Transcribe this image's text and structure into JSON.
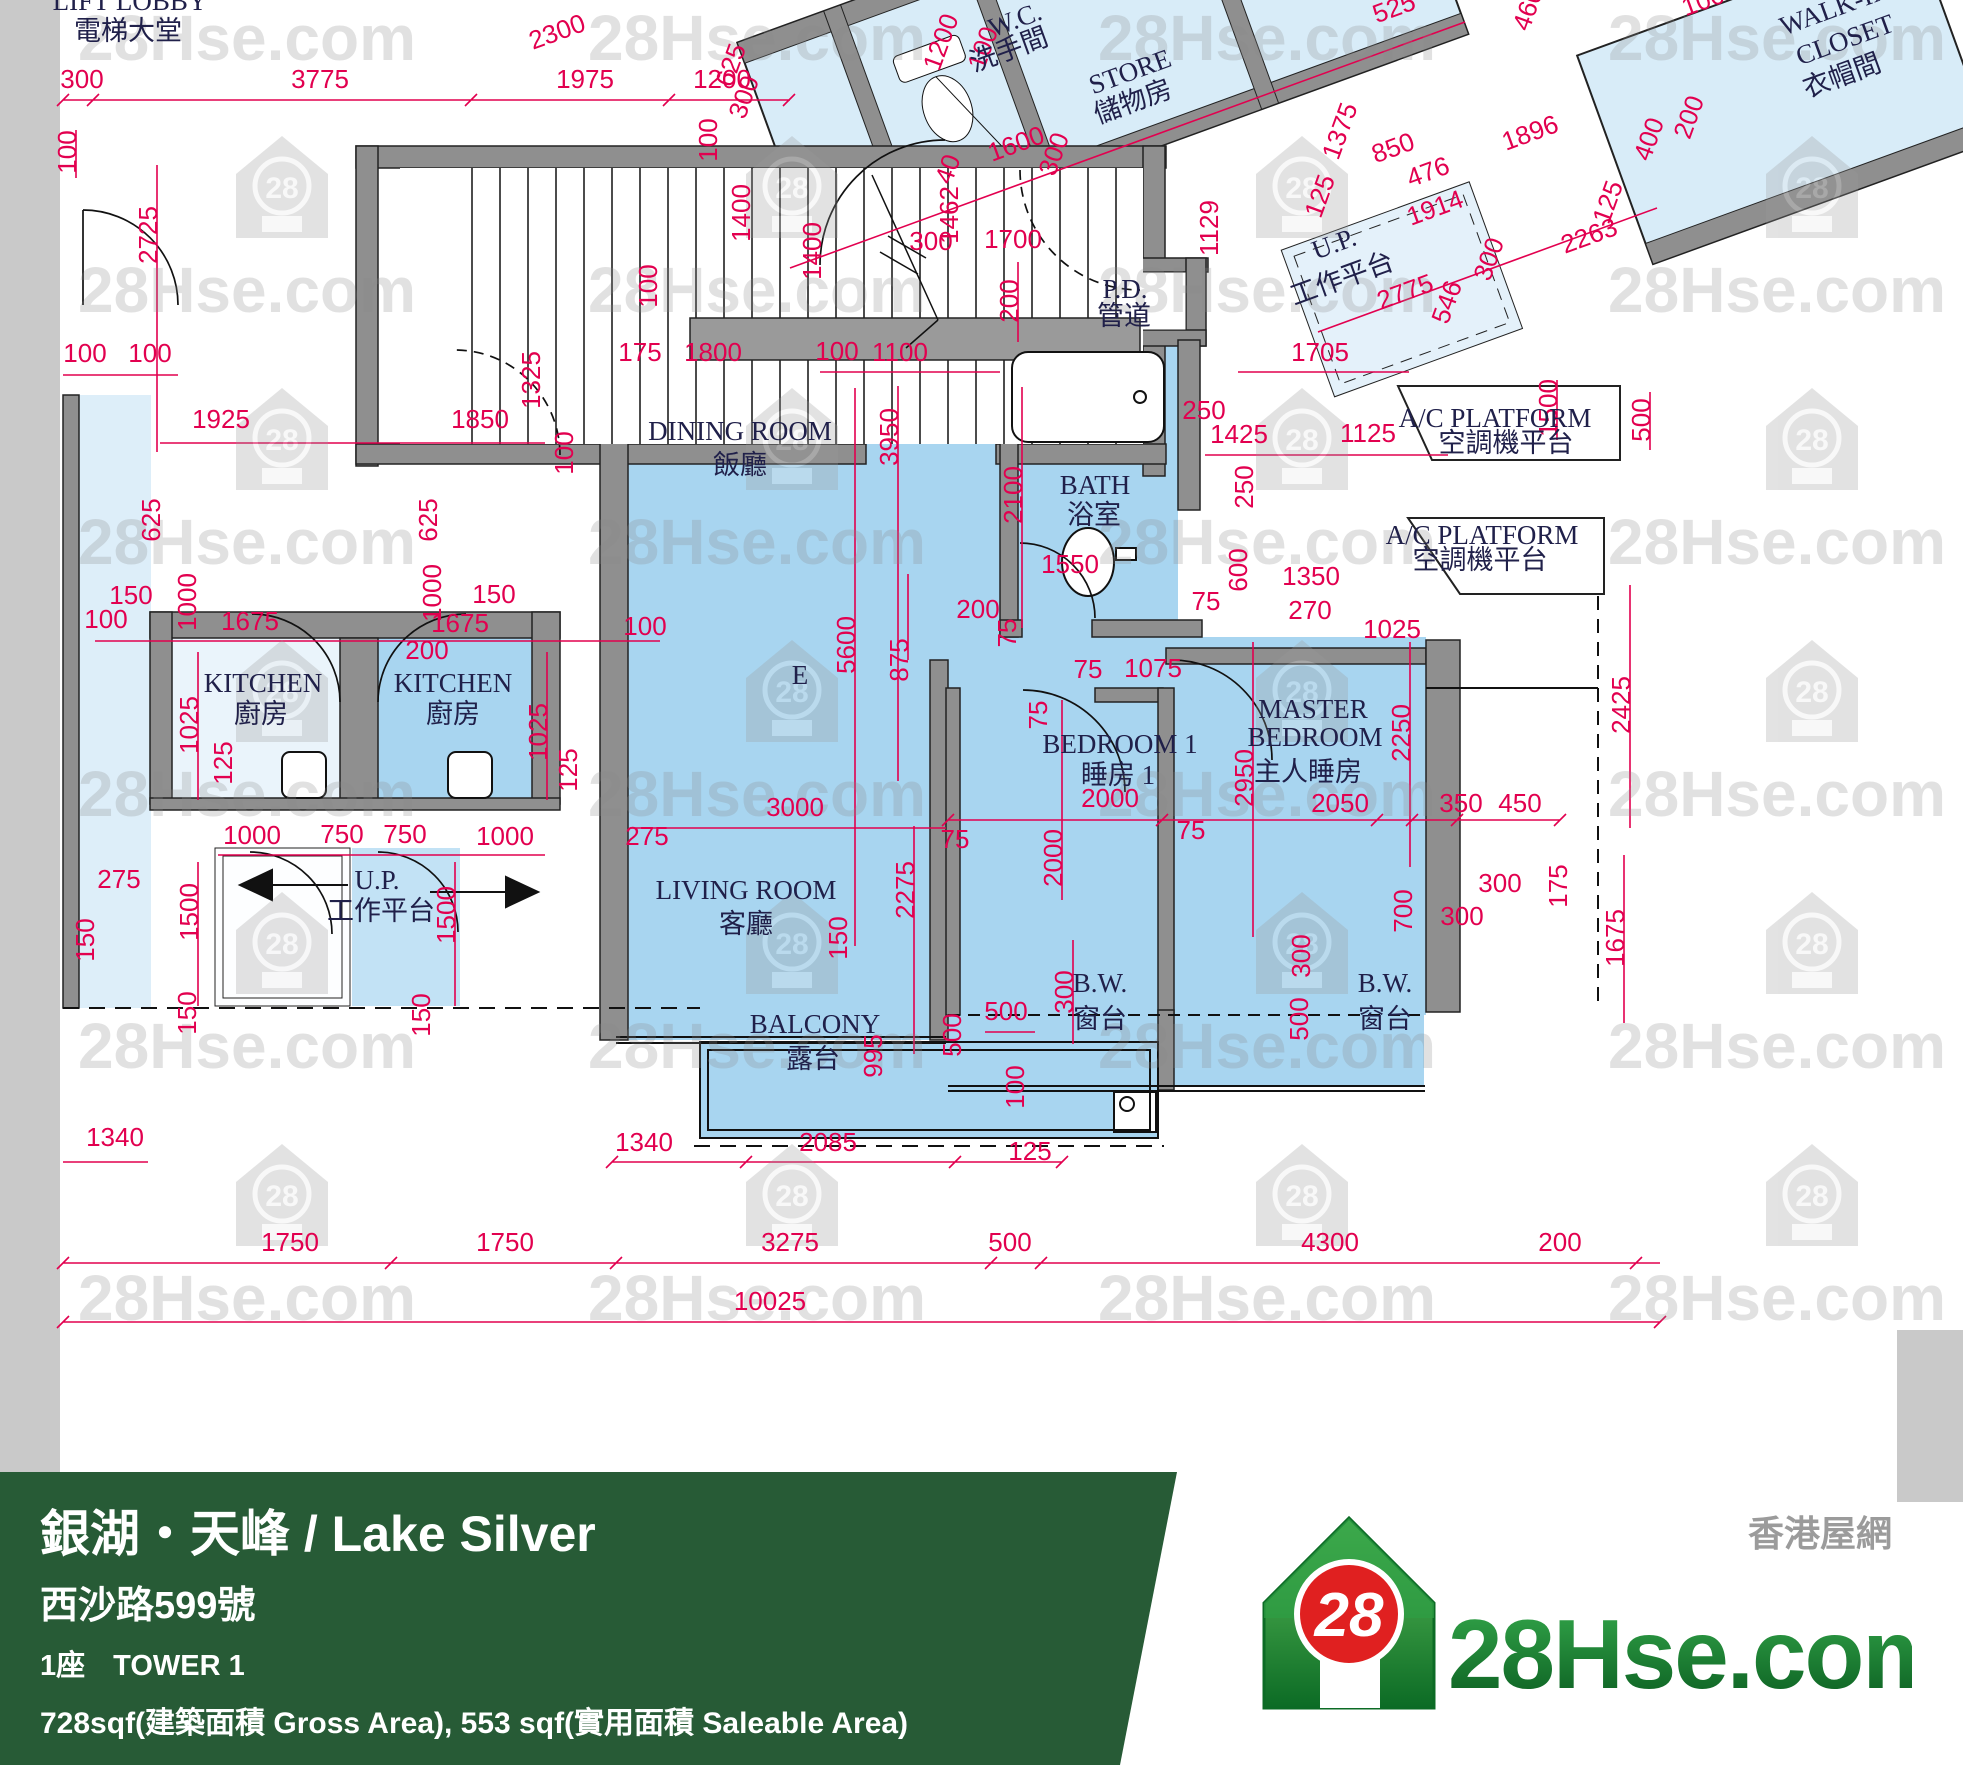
{
  "meta": {
    "site": "28Hse.com",
    "type": "floor-plan"
  },
  "watermark": {
    "text": "28Hse.com",
    "house_number": "28",
    "text_cols": [
      247,
      757,
      1267,
      1777
    ],
    "text_rows": [
      60,
      312,
      564,
      816,
      1068,
      1320
    ],
    "house_cols": [
      282,
      792,
      1302,
      1812
    ],
    "house_rows": [
      186,
      438,
      690,
      942,
      1194
    ]
  },
  "plan": {
    "unit_letter": "E",
    "room_labels": [
      {
        "t": "LIFT LOBBY",
        "x": 130,
        "y": 10,
        "s": 26
      },
      {
        "t": "電梯大堂",
        "x": 128,
        "y": 40,
        "s": 30
      },
      {
        "t": "W.C.",
        "x": 1018,
        "y": 28,
        "r": -20,
        "s": 26
      },
      {
        "t": "洗手間",
        "x": 1012,
        "y": 58,
        "r": -20,
        "s": 27
      },
      {
        "t": "STORE",
        "x": 1133,
        "y": 80,
        "r": -20,
        "s": 26
      },
      {
        "t": "儲物房",
        "x": 1136,
        "y": 110,
        "r": -20,
        "s": 27
      },
      {
        "t": "WALK-IN",
        "x": 1838,
        "y": 16,
        "r": -20,
        "s": 26
      },
      {
        "t": "CLOSET",
        "x": 1848,
        "y": 48,
        "r": -20,
        "s": 26
      },
      {
        "t": "衣帽間",
        "x": 1845,
        "y": 84,
        "r": -20,
        "s": 27
      },
      {
        "t": "U.P.",
        "x": 1337,
        "y": 252,
        "r": -20,
        "s": 24
      },
      {
        "t": "工作平台",
        "x": 1345,
        "y": 287,
        "r": -20,
        "s": 26
      },
      {
        "t": "P.D.",
        "x": 1125,
        "y": 298,
        "s": 25
      },
      {
        "t": "管道",
        "x": 1124,
        "y": 325,
        "s": 26
      },
      {
        "t": "A/C PLATFORM",
        "x": 1495,
        "y": 427,
        "s": 23
      },
      {
        "t": "空調機平台",
        "x": 1506,
        "y": 452,
        "s": 24
      },
      {
        "t": "A/C PLATFORM",
        "x": 1482,
        "y": 544,
        "s": 23
      },
      {
        "t": "空調機平台",
        "x": 1480,
        "y": 569,
        "s": 24
      },
      {
        "t": "DINING ROOM",
        "x": 740,
        "y": 440,
        "s": 28
      },
      {
        "t": "飯廳",
        "x": 740,
        "y": 474,
        "s": 30
      },
      {
        "t": "KITCHEN",
        "x": 263,
        "y": 692,
        "s": 27
      },
      {
        "t": "廚房",
        "x": 261,
        "y": 723,
        "s": 29
      },
      {
        "t": "KITCHEN",
        "x": 453,
        "y": 692,
        "s": 27
      },
      {
        "t": "廚房",
        "x": 453,
        "y": 723,
        "s": 29
      },
      {
        "t": "E",
        "x": 800,
        "y": 684,
        "s": 52
      },
      {
        "t": "BATH",
        "x": 1095,
        "y": 494,
        "s": 26
      },
      {
        "t": "浴室",
        "x": 1094,
        "y": 524,
        "s": 28
      },
      {
        "t": "BEDROOM 1",
        "x": 1120,
        "y": 753,
        "s": 27
      },
      {
        "t": "睡房 1",
        "x": 1118,
        "y": 784,
        "s": 29
      },
      {
        "t": "MASTER",
        "x": 1313,
        "y": 718,
        "s": 27
      },
      {
        "t": "BEDROOM",
        "x": 1315,
        "y": 746,
        "s": 27
      },
      {
        "t": "主人睡房",
        "x": 1308,
        "y": 781,
        "s": 29
      },
      {
        "t": "LIVING ROOM",
        "x": 746,
        "y": 899,
        "s": 28
      },
      {
        "t": "客廳",
        "x": 746,
        "y": 933,
        "s": 30
      },
      {
        "t": "U.P.",
        "x": 377,
        "y": 889,
        "s": 24
      },
      {
        "t": "工作平台",
        "x": 381,
        "y": 920,
        "s": 26
      },
      {
        "t": "BALCONY",
        "x": 815,
        "y": 1033,
        "s": 27
      },
      {
        "t": "露台",
        "x": 813,
        "y": 1068,
        "s": 29
      },
      {
        "t": "B.W.",
        "x": 1100,
        "y": 992,
        "s": 26
      },
      {
        "t": "窗台",
        "x": 1100,
        "y": 1028,
        "s": 28
      },
      {
        "t": "B.W.",
        "x": 1385,
        "y": 992,
        "s": 26
      },
      {
        "t": "窗台",
        "x": 1385,
        "y": 1028,
        "s": 28
      }
    ],
    "dims": [
      {
        "t": "300",
        "x": 82,
        "y": 88
      },
      {
        "t": "3775",
        "x": 320,
        "y": 88
      },
      {
        "t": "1975",
        "x": 585,
        "y": 88
      },
      {
        "t": "1200",
        "x": 722,
        "y": 88
      },
      {
        "t": "2300",
        "x": 560,
        "y": 40,
        "r": -20
      },
      {
        "t": "625",
        "x": 739,
        "y": 68,
        "r": -70
      },
      {
        "t": "300",
        "x": 752,
        "y": 100,
        "r": -70
      },
      {
        "t": "100",
        "x": 717,
        "y": 140,
        "r": -90
      },
      {
        "t": "1200",
        "x": 949,
        "y": 45,
        "r": -70
      },
      {
        "t": "100",
        "x": 991,
        "y": 51,
        "r": -70
      },
      {
        "t": "1600",
        "x": 1019,
        "y": 152,
        "r": -20
      },
      {
        "t": "300",
        "x": 1062,
        "y": 157,
        "r": -70
      },
      {
        "t": "40",
        "x": 956,
        "y": 172,
        "r": -70
      },
      {
        "t": "1462",
        "x": 958,
        "y": 215,
        "r": -90
      },
      {
        "t": "300",
        "x": 931,
        "y": 250
      },
      {
        "t": "1700",
        "x": 1013,
        "y": 248
      },
      {
        "t": "200",
        "x": 1018,
        "y": 301,
        "r": -90
      },
      {
        "t": "1129",
        "x": 1218,
        "y": 228,
        "r": -90
      },
      {
        "t": "525",
        "x": 1397,
        "y": 16,
        "r": -20
      },
      {
        "t": "460",
        "x": 1536,
        "y": 12,
        "r": -70
      },
      {
        "t": "100",
        "x": 1706,
        "y": 9,
        "r": -20
      },
      {
        "t": "1375",
        "x": 1348,
        "y": 134,
        "r": -70
      },
      {
        "t": "850",
        "x": 1396,
        "y": 156,
        "r": -20
      },
      {
        "t": "476",
        "x": 1431,
        "y": 180,
        "r": -20
      },
      {
        "t": "1914",
        "x": 1438,
        "y": 216,
        "r": -20
      },
      {
        "t": "1896",
        "x": 1533,
        "y": 141,
        "r": -20
      },
      {
        "t": "125",
        "x": 1328,
        "y": 199,
        "r": -70
      },
      {
        "t": "125",
        "x": 1616,
        "y": 205,
        "r": -70
      },
      {
        "t": "400",
        "x": 1657,
        "y": 142,
        "r": -70
      },
      {
        "t": "200",
        "x": 1697,
        "y": 120,
        "r": -70
      },
      {
        "t": "2263",
        "x": 1592,
        "y": 244,
        "r": -20
      },
      {
        "t": "546",
        "x": 1455,
        "y": 305,
        "r": -70
      },
      {
        "t": "300",
        "x": 1497,
        "y": 262,
        "r": -70
      },
      {
        "t": "2775",
        "x": 1408,
        "y": 300,
        "r": -20
      },
      {
        "t": "1705",
        "x": 1320,
        "y": 361
      },
      {
        "t": "1500",
        "x": 1557,
        "y": 408,
        "r": -90
      },
      {
        "t": "500",
        "x": 1650,
        "y": 420,
        "r": -90
      },
      {
        "t": "1425",
        "x": 1239,
        "y": 443
      },
      {
        "t": "1125",
        "x": 1368,
        "y": 442
      },
      {
        "t": "250",
        "x": 1204,
        "y": 419
      },
      {
        "t": "250",
        "x": 1253,
        "y": 487,
        "r": -90
      },
      {
        "t": "1400",
        "x": 750,
        "y": 213,
        "r": -90
      },
      {
        "t": "1400",
        "x": 821,
        "y": 251,
        "r": -90
      },
      {
        "t": "100",
        "x": 657,
        "y": 286,
        "r": -90
      },
      {
        "t": "175",
        "x": 640,
        "y": 361
      },
      {
        "t": "1800",
        "x": 713,
        "y": 361
      },
      {
        "t": "100",
        "x": 837,
        "y": 360
      },
      {
        "t": "1100",
        "x": 900,
        "y": 361
      },
      {
        "t": "3950",
        "x": 898,
        "y": 437,
        "r": -90
      },
      {
        "t": "1925",
        "x": 221,
        "y": 428
      },
      {
        "t": "1850",
        "x": 480,
        "y": 428
      },
      {
        "t": "1325",
        "x": 540,
        "y": 380,
        "r": -90
      },
      {
        "t": "100",
        "x": 573,
        "y": 453,
        "r": -90
      },
      {
        "t": "100",
        "x": 85,
        "y": 362
      },
      {
        "t": "100",
        "x": 150,
        "y": 362
      },
      {
        "t": "2725",
        "x": 157,
        "y": 235,
        "r": -90
      },
      {
        "t": "100",
        "x": 76,
        "y": 152,
        "r": -90
      },
      {
        "t": "625",
        "x": 160,
        "y": 520,
        "r": -90
      },
      {
        "t": "625",
        "x": 437,
        "y": 520,
        "r": -90
      },
      {
        "t": "150",
        "x": 131,
        "y": 604
      },
      {
        "t": "1000",
        "x": 196,
        "y": 602,
        "r": -90
      },
      {
        "t": "150",
        "x": 494,
        "y": 603
      },
      {
        "t": "1000",
        "x": 441,
        "y": 593,
        "r": -90
      },
      {
        "t": "100",
        "x": 106,
        "y": 628
      },
      {
        "t": "1675",
        "x": 250,
        "y": 630
      },
      {
        "t": "1675",
        "x": 460,
        "y": 632
      },
      {
        "t": "200",
        "x": 427,
        "y": 659
      },
      {
        "t": "100",
        "x": 645,
        "y": 635
      },
      {
        "t": "1025",
        "x": 198,
        "y": 725,
        "r": -90
      },
      {
        "t": "125",
        "x": 232,
        "y": 763,
        "r": -90
      },
      {
        "t": "1025",
        "x": 547,
        "y": 732,
        "r": -90
      },
      {
        "t": "125",
        "x": 577,
        "y": 770,
        "r": -90
      },
      {
        "t": "1000",
        "x": 252,
        "y": 844
      },
      {
        "t": "750",
        "x": 342,
        "y": 843
      },
      {
        "t": "750",
        "x": 405,
        "y": 843
      },
      {
        "t": "1000",
        "x": 505,
        "y": 845
      },
      {
        "t": "275",
        "x": 119,
        "y": 888
      },
      {
        "t": "1500",
        "x": 198,
        "y": 912,
        "r": -90
      },
      {
        "t": "150",
        "x": 94,
        "y": 940,
        "r": -90
      },
      {
        "t": "150",
        "x": 196,
        "y": 1013,
        "r": -90
      },
      {
        "t": "1500",
        "x": 455,
        "y": 915,
        "r": -90
      },
      {
        "t": "150",
        "x": 430,
        "y": 1015,
        "r": -90
      },
      {
        "t": "275",
        "x": 647,
        "y": 845
      },
      {
        "t": "3000",
        "x": 795,
        "y": 816
      },
      {
        "t": "75",
        "x": 955,
        "y": 848
      },
      {
        "t": "2275",
        "x": 914,
        "y": 890,
        "r": -90
      },
      {
        "t": "150",
        "x": 847,
        "y": 938,
        "r": -90
      },
      {
        "t": "5600",
        "x": 855,
        "y": 645,
        "r": -90
      },
      {
        "t": "875",
        "x": 908,
        "y": 660,
        "r": -90
      },
      {
        "t": "200",
        "x": 978,
        "y": 618
      },
      {
        "t": "75",
        "x": 1016,
        "y": 633,
        "r": -90
      },
      {
        "t": "1550",
        "x": 1070,
        "y": 573
      },
      {
        "t": "2100",
        "x": 1022,
        "y": 495,
        "r": -90
      },
      {
        "t": "600",
        "x": 1247,
        "y": 570,
        "r": -90
      },
      {
        "t": "75",
        "x": 1206,
        "y": 610
      },
      {
        "t": "1350",
        "x": 1311,
        "y": 585
      },
      {
        "t": "270",
        "x": 1310,
        "y": 619
      },
      {
        "t": "1025",
        "x": 1392,
        "y": 638
      },
      {
        "t": "75",
        "x": 1088,
        "y": 678
      },
      {
        "t": "1075",
        "x": 1153,
        "y": 677
      },
      {
        "t": "75",
        "x": 1047,
        "y": 715,
        "r": -90
      },
      {
        "t": "2000",
        "x": 1110,
        "y": 807
      },
      {
        "t": "2000",
        "x": 1062,
        "y": 858,
        "r": -90
      },
      {
        "t": "2950",
        "x": 1253,
        "y": 778,
        "r": -90
      },
      {
        "t": "2050",
        "x": 1340,
        "y": 812
      },
      {
        "t": "2250",
        "x": 1410,
        "y": 733,
        "r": -90
      },
      {
        "t": "350",
        "x": 1461,
        "y": 812
      },
      {
        "t": "450",
        "x": 1520,
        "y": 812
      },
      {
        "t": "75",
        "x": 1191,
        "y": 839
      },
      {
        "t": "700",
        "x": 1412,
        "y": 911,
        "r": -90
      },
      {
        "t": "300",
        "x": 1500,
        "y": 892
      },
      {
        "t": "300",
        "x": 1462,
        "y": 925
      },
      {
        "t": "175",
        "x": 1567,
        "y": 886,
        "r": -90
      },
      {
        "t": "1675",
        "x": 1624,
        "y": 938,
        "r": -90
      },
      {
        "t": "2425",
        "x": 1630,
        "y": 705,
        "r": -90
      },
      {
        "t": "300",
        "x": 1073,
        "y": 992,
        "r": -90
      },
      {
        "t": "500",
        "x": 961,
        "y": 1035,
        "r": -90
      },
      {
        "t": "300",
        "x": 1310,
        "y": 956,
        "r": -90
      },
      {
        "t": "500",
        "x": 1308,
        "y": 1019,
        "r": -90
      },
      {
        "t": "500",
        "x": 1006,
        "y": 1020
      },
      {
        "t": "995",
        "x": 882,
        "y": 1056,
        "r": -90
      },
      {
        "t": "100",
        "x": 1024,
        "y": 1087,
        "r": -90
      },
      {
        "t": "125",
        "x": 1030,
        "y": 1160
      },
      {
        "t": "1340",
        "x": 115,
        "y": 1146
      },
      {
        "t": "1340",
        "x": 644,
        "y": 1151
      },
      {
        "t": "2085",
        "x": 828,
        "y": 1151
      },
      {
        "t": "1750",
        "x": 290,
        "y": 1251
      },
      {
        "t": "1750",
        "x": 505,
        "y": 1251
      },
      {
        "t": "3275",
        "x": 790,
        "y": 1251
      },
      {
        "t": "500",
        "x": 1010,
        "y": 1251
      },
      {
        "t": "4300",
        "x": 1330,
        "y": 1251
      },
      {
        "t": "200",
        "x": 1560,
        "y": 1251
      },
      {
        "t": "10025",
        "x": 770,
        "y": 1310
      }
    ]
  },
  "footer": {
    "title": "銀湖‧天峰 / Lake Silver",
    "address": "西沙路599號",
    "tower_zh": "1座",
    "tower_en": "TOWER 1",
    "area": "728sqf(建築面積 Gross Area), 553 sqf(實用面積 Saleable Area)",
    "logo": {
      "number": "28",
      "site": "28Hse.com",
      "tagline": "香港屋網"
    },
    "colors": {
      "banner": "#275b36",
      "logo_green": "#128a39",
      "logo_red": "#e02020",
      "dim_red": "#e2004f"
    }
  }
}
